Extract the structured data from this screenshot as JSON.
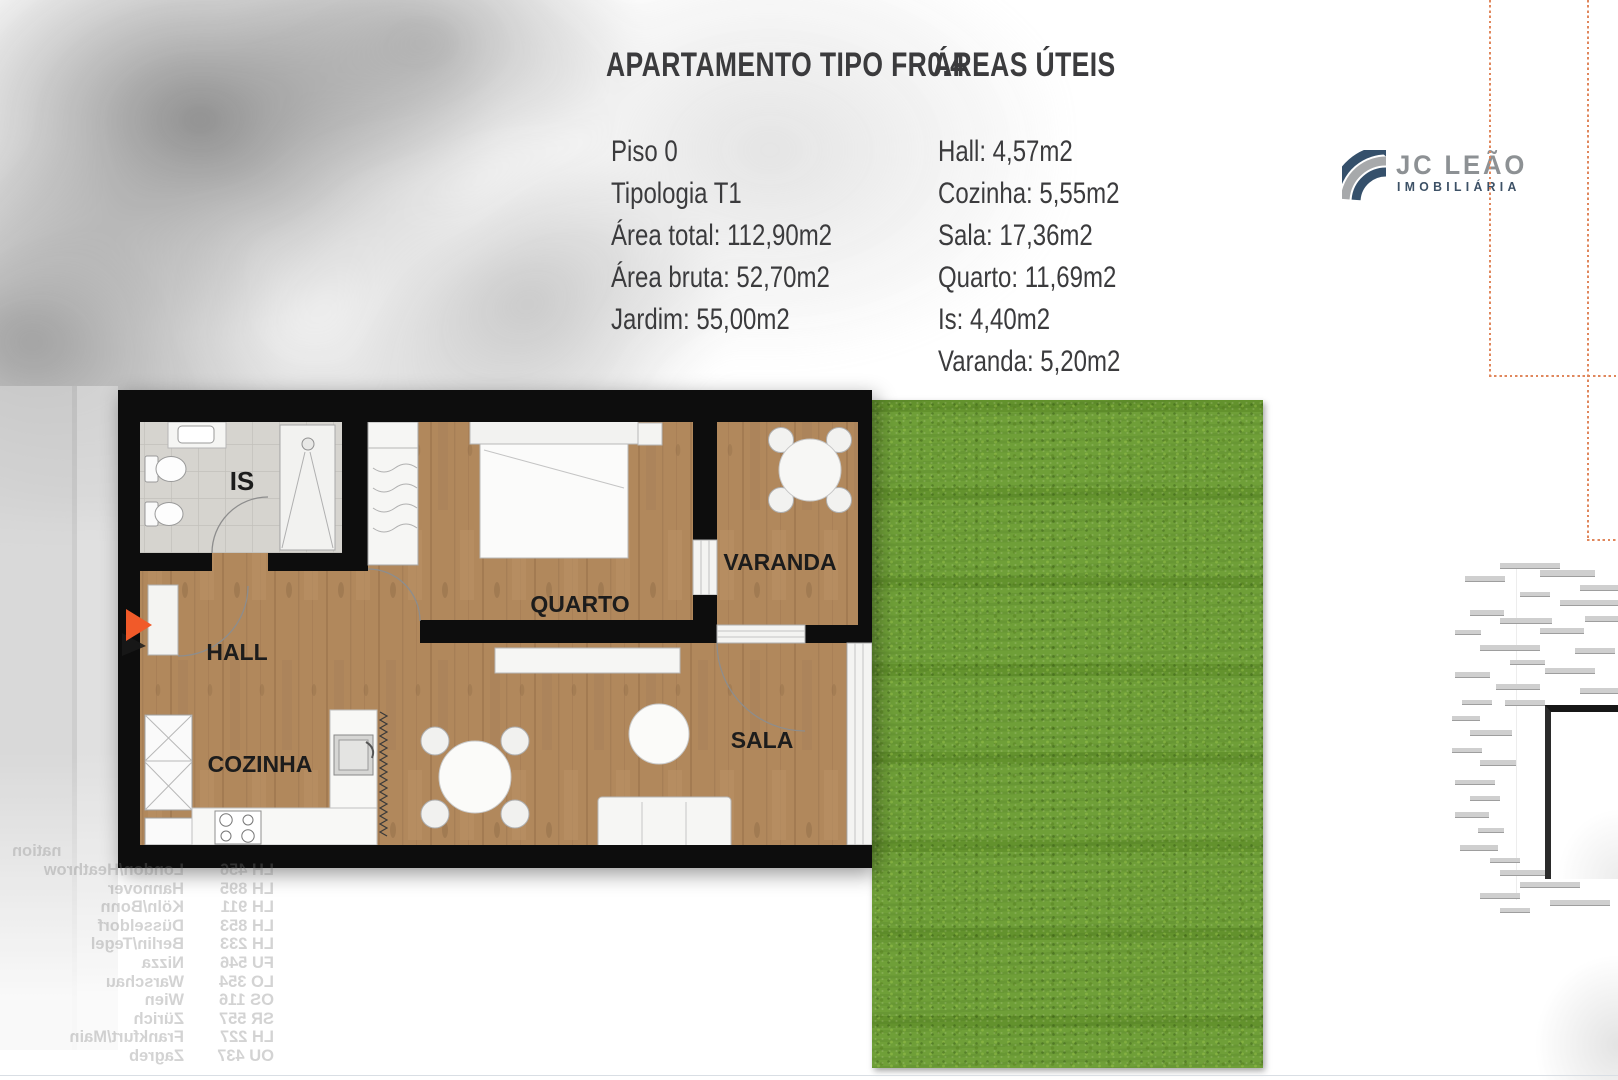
{
  "header": {
    "title": "APARTAMENTO TIPO FR0.4",
    "areas_title": "ÁREAS ÚTEIS"
  },
  "details": {
    "lines": [
      "Piso 0",
      "Tipologia T1",
      "Área total: 112,90m2",
      "Área bruta: 52,70m2",
      "Jardim: 55,00m2"
    ]
  },
  "areas": {
    "lines": [
      "Hall: 4,57m2",
      "Cozinha: 5,55m2",
      "Sala: 17,36m2",
      "Quarto: 11,69m2",
      "Is: 4,40m2",
      "Varanda: 5,20m2"
    ]
  },
  "logo": {
    "name": "JC LEÃO",
    "subtitle": "IMOBILIÁRIA"
  },
  "floorplan": {
    "rooms": {
      "is": "IS",
      "hall": "HALL",
      "cozinha": "COZINHA",
      "quarto": "QUARTO",
      "varanda": "VARANDA",
      "sala": "SALA"
    }
  },
  "board": {
    "header_fragment": "nation",
    "rows": [
      {
        "code": "LH 456",
        "city": "London/Heathrow"
      },
      {
        "code": "LH 895",
        "city": "Hannover"
      },
      {
        "code": "LH 911",
        "city": "Köln/Bonn"
      },
      {
        "code": "LH 853",
        "city": "Düsseldorf"
      },
      {
        "code": "LH 233",
        "city": "Berlin/Tegel"
      },
      {
        "code": "FU 546",
        "city": "Nizza"
      },
      {
        "code": "LO 354",
        "city": "Warschau"
      },
      {
        "code": "OS 116",
        "city": "Wien"
      },
      {
        "code": "SR 557",
        "city": "Zürich"
      },
      {
        "code": "LH 227",
        "city": "Frankfurt/Main"
      },
      {
        "code": "OU 437",
        "city": "Zagreb"
      }
    ]
  },
  "colors": {
    "accent_orange": "#F15A29",
    "dotted_guide": "#E0875C",
    "logo_navy": "#35506B",
    "logo_gray": "#A7A9AB",
    "grass_green": "#699B30",
    "text": "#3B3B3D"
  }
}
